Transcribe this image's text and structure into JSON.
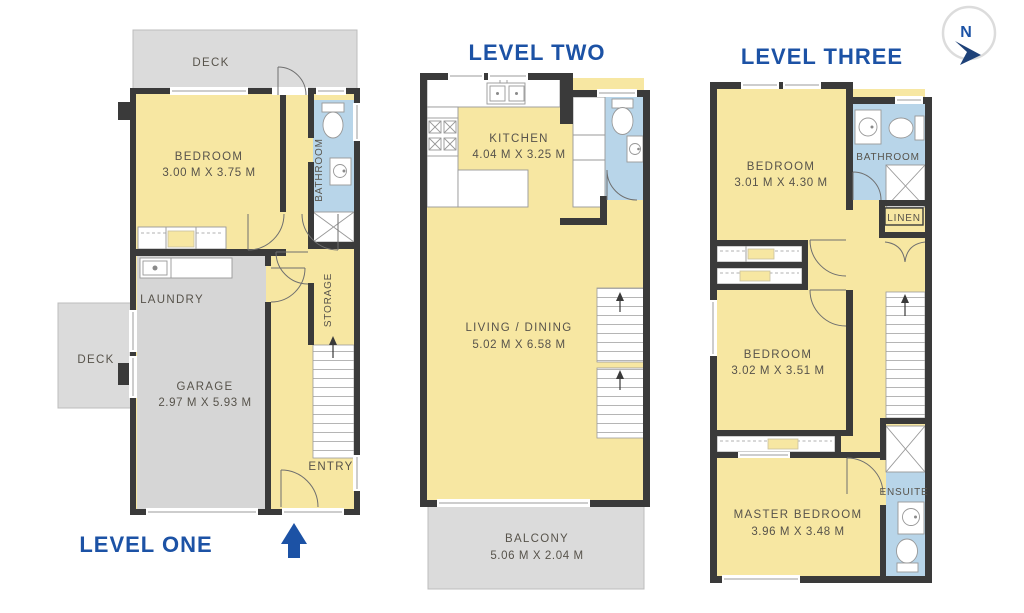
{
  "colors": {
    "room_yellow": "#f7e7a2",
    "wet_area_blue": "#b8d5e9",
    "deck_gray": "#dbdbdb",
    "garage_gray": "#d6d6d6",
    "wall_dark": "#3a3a3a",
    "title_blue": "#1c52a5",
    "label_gray": "#57534b"
  },
  "compass": {
    "north_label": "N"
  },
  "level_one": {
    "title": "LEVEL ONE",
    "deck_top": "DECK",
    "deck_left": "DECK",
    "bedroom": {
      "name": "BEDROOM",
      "dims": "3.00 M X 3.75 M"
    },
    "bathroom": "BATHROOM",
    "laundry": "LAUNDRY",
    "garage": {
      "name": "GARAGE",
      "dims": "2.97 M X 5.93 M"
    },
    "storage": "STORAGE",
    "entry": "ENTRY"
  },
  "level_two": {
    "title": "LEVEL TWO",
    "kitchen": {
      "name": "KITCHEN",
      "dims": "4.04 M X 3.25 M"
    },
    "living_dining": {
      "name": "LIVING / DINING",
      "dims": "5.02 M X 6.58 M"
    },
    "balcony": {
      "name": "BALCONY",
      "dims": "5.06 M X 2.04 M"
    }
  },
  "level_three": {
    "title": "LEVEL THREE",
    "bedroom_front": {
      "name": "BEDROOM",
      "dims": "3.01 M X 4.30 M"
    },
    "bathroom": "BATHROOM",
    "linen": "LINEN",
    "bedroom_middle": {
      "name": "BEDROOM",
      "dims": "3.02 M X 3.51 M"
    },
    "master_bedroom": {
      "name": "MASTER BEDROOM",
      "dims": "3.96 M X 3.48 M"
    },
    "ensuite": "ENSUITE"
  }
}
